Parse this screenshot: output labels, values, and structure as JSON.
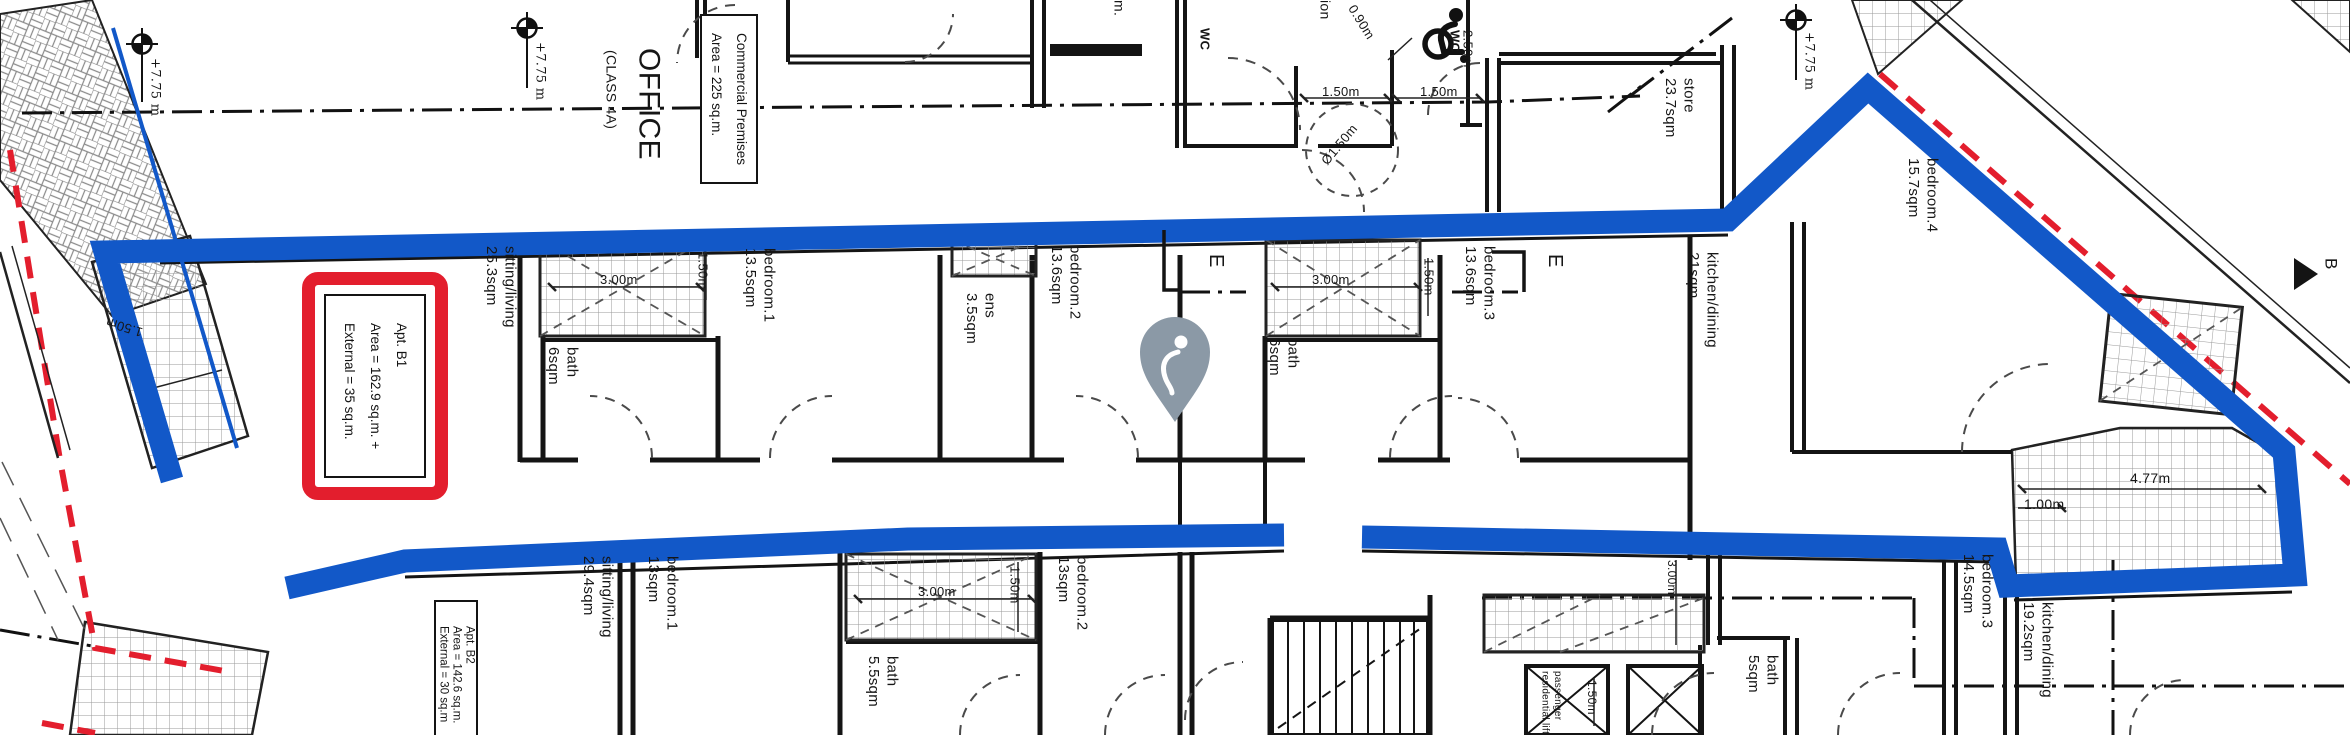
{
  "colors": {
    "highlight_blue": "#1258c8",
    "boundary_red": "#e31e2d",
    "pin_gray": "#8b99a6",
    "line_black": "#141414"
  },
  "apartments": {
    "b1": {
      "text": "Apt. B1\nArea = 162.9 sq.m. +\nExternal = 35 sq.m."
    },
    "b2": {
      "text": "Apt. B2\nArea = 142.6 sq.m.\nExternal = 30 sq.m"
    }
  },
  "office": {
    "premises_box": "Commercial Premises\nArea = 225 sq.m."
  },
  "icons": {
    "map_pin": "location-pin",
    "wheelchair": "accessible-wc",
    "level_marker": "survey-level-crosshair"
  },
  "labels": [
    {
      "n": "room-sitting-living-b1",
      "t": "sitting/living\n25.3sqm",
      "x": 481,
      "y": 246
    },
    {
      "n": "room-bath-b1",
      "t": "bath\n6sqm",
      "x": 543,
      "y": 347
    },
    {
      "n": "room-bedroom1-b1",
      "t": "bedroom.1\n13.5sqm",
      "x": 740,
      "y": 248
    },
    {
      "n": "room-ens-b1",
      "t": "ens\n3.5sqm",
      "x": 961,
      "y": 293
    },
    {
      "n": "room-bedroom2-b1",
      "t": "bedroom.2\n13.6sqm",
      "x": 1046,
      "y": 245
    },
    {
      "n": "room-bath2-b1",
      "t": "bath\n6sqm",
      "x": 1264,
      "y": 338
    },
    {
      "n": "room-bedroom3-b1",
      "t": "bedroom.3\n13.6sqm",
      "x": 1460,
      "y": 246
    },
    {
      "n": "room-kitchen-dining-b1",
      "t": "kitchen/dining\n21sqm",
      "x": 1683,
      "y": 252
    },
    {
      "n": "room-bedroom4",
      "t": "bedroom.4\n15.7sqm",
      "x": 1903,
      "y": 158
    },
    {
      "n": "room-store",
      "t": "store\n23.7sqm",
      "x": 1660,
      "y": 78
    },
    {
      "n": "room-sitting-living-b2",
      "t": "sitting/living\n29.4sqm",
      "x": 578,
      "y": 556
    },
    {
      "n": "room-bedroom1-b2",
      "t": "bedroom.1\n13sqm",
      "x": 643,
      "y": 556
    },
    {
      "n": "room-bedroom2-b2",
      "t": "bedroom.2\n13sqm",
      "x": 1053,
      "y": 556
    },
    {
      "n": "room-bath-b2",
      "t": "bath\n5.5sqm",
      "x": 863,
      "y": 656
    },
    {
      "n": "room-bath-b3",
      "t": "bath\n5sqm",
      "x": 1743,
      "y": 655
    },
    {
      "n": "room-bedroom3-b2",
      "t": "bedroom.3\n14.5sqm",
      "x": 1958,
      "y": 554
    },
    {
      "n": "room-kitchen-dining-b2",
      "t": "kitchen/dining\n19.2sqm",
      "x": 2018,
      "y": 602
    },
    {
      "n": "lift-label",
      "t": "passenger\nresidential lift",
      "x": 1538,
      "y": 671,
      "s": 10
    },
    {
      "n": "dim-3m-shaft1",
      "t": "3.00m",
      "x": 600,
      "y": 272,
      "m": "h",
      "s": 13
    },
    {
      "n": "dim-150-shaft1",
      "t": "1.50m",
      "x": 694,
      "y": 252,
      "s": 13
    },
    {
      "n": "dim-3m-shaft3",
      "t": "3.00m",
      "x": 1312,
      "y": 272,
      "m": "h",
      "s": 13
    },
    {
      "n": "dim-150-shaft3",
      "t": "1.50m",
      "x": 1420,
      "y": 258,
      "s": 13
    },
    {
      "n": "dim-3m-shaft4",
      "t": "3.00m",
      "x": 918,
      "y": 584,
      "m": "h",
      "s": 13
    },
    {
      "n": "dim-150-shaft4",
      "t": "1.50m",
      "x": 1006,
      "y": 566,
      "s": 13
    },
    {
      "n": "dim-150-wc-1",
      "t": "1.50m",
      "x": 1322,
      "y": 84,
      "m": "h",
      "s": 13
    },
    {
      "n": "dim-150-wc-2",
      "t": "1.50m",
      "x": 1420,
      "y": 84,
      "m": "h",
      "s": 13
    },
    {
      "n": "dim-250-wc",
      "t": "2.50m",
      "x": 1459,
      "y": 30,
      "s": 13
    },
    {
      "n": "dim-090-wc",
      "t": "0.90m",
      "x": 1358,
      "y": 2,
      "m": "h",
      "r": 58,
      "s": 13
    },
    {
      "n": "dim-dia150",
      "t": "Ø1.50m",
      "x": 1318,
      "y": 158,
      "m": "h",
      "r": -50,
      "s": 13
    },
    {
      "n": "dim-477",
      "t": "4.77m",
      "x": 2130,
      "y": 470,
      "m": "h",
      "s": 14
    },
    {
      "n": "dim-100",
      "t": "1.00m",
      "x": 2024,
      "y": 496,
      "m": "h",
      "s": 14
    },
    {
      "n": "dim-150-terrace",
      "t": "1.50m",
      "x": 140,
      "y": 340,
      "m": "h",
      "r": 197,
      "s": 13
    },
    {
      "n": "dim-150-lift",
      "t": "1.50m",
      "x": 1584,
      "y": 680,
      "s": 12
    },
    {
      "n": "dim-3m-br",
      "t": "3.00m",
      "x": 1664,
      "y": 560,
      "s": 12
    },
    {
      "n": "wc-label-1",
      "t": "WC",
      "x": 1196,
      "y": 28,
      "s": 13,
      "b": 1
    },
    {
      "n": "wc-label-2",
      "t": "WC",
      "x": 1446,
      "y": 30,
      "s": 13,
      "b": 1
    },
    {
      "n": "partial-label-ion",
      "t": "ion",
      "x": 1316,
      "y": 0,
      "s": 14
    },
    {
      "n": "partial-label-m",
      "t": "m.",
      "x": 1110,
      "y": 0,
      "s": 14
    },
    {
      "n": "level-775-1",
      "t": "+7.75 m",
      "x": 146,
      "y": 58,
      "s": 13,
      "f": 1
    },
    {
      "n": "level-775-2",
      "t": "+7.75 m",
      "x": 531,
      "y": 42,
      "s": 13,
      "f": 1
    },
    {
      "n": "level-775-3",
      "t": "+7.75 m",
      "x": 1800,
      "y": 32,
      "s": 13,
      "f": 1
    },
    {
      "n": "section-e-1",
      "t": "E",
      "x": 1203,
      "y": 254,
      "s": 20
    },
    {
      "n": "section-e-2",
      "t": "E",
      "x": 1542,
      "y": 254,
      "s": 20
    },
    {
      "n": "section-b",
      "t": "B",
      "x": 2320,
      "y": 258,
      "s": 17
    },
    {
      "n": "office-title",
      "t": "OFFICE",
      "x": 630,
      "y": 48,
      "s": 30
    },
    {
      "n": "office-class",
      "t": "(CLASS 4A)",
      "x": 602,
      "y": 50,
      "s": 14
    }
  ]
}
